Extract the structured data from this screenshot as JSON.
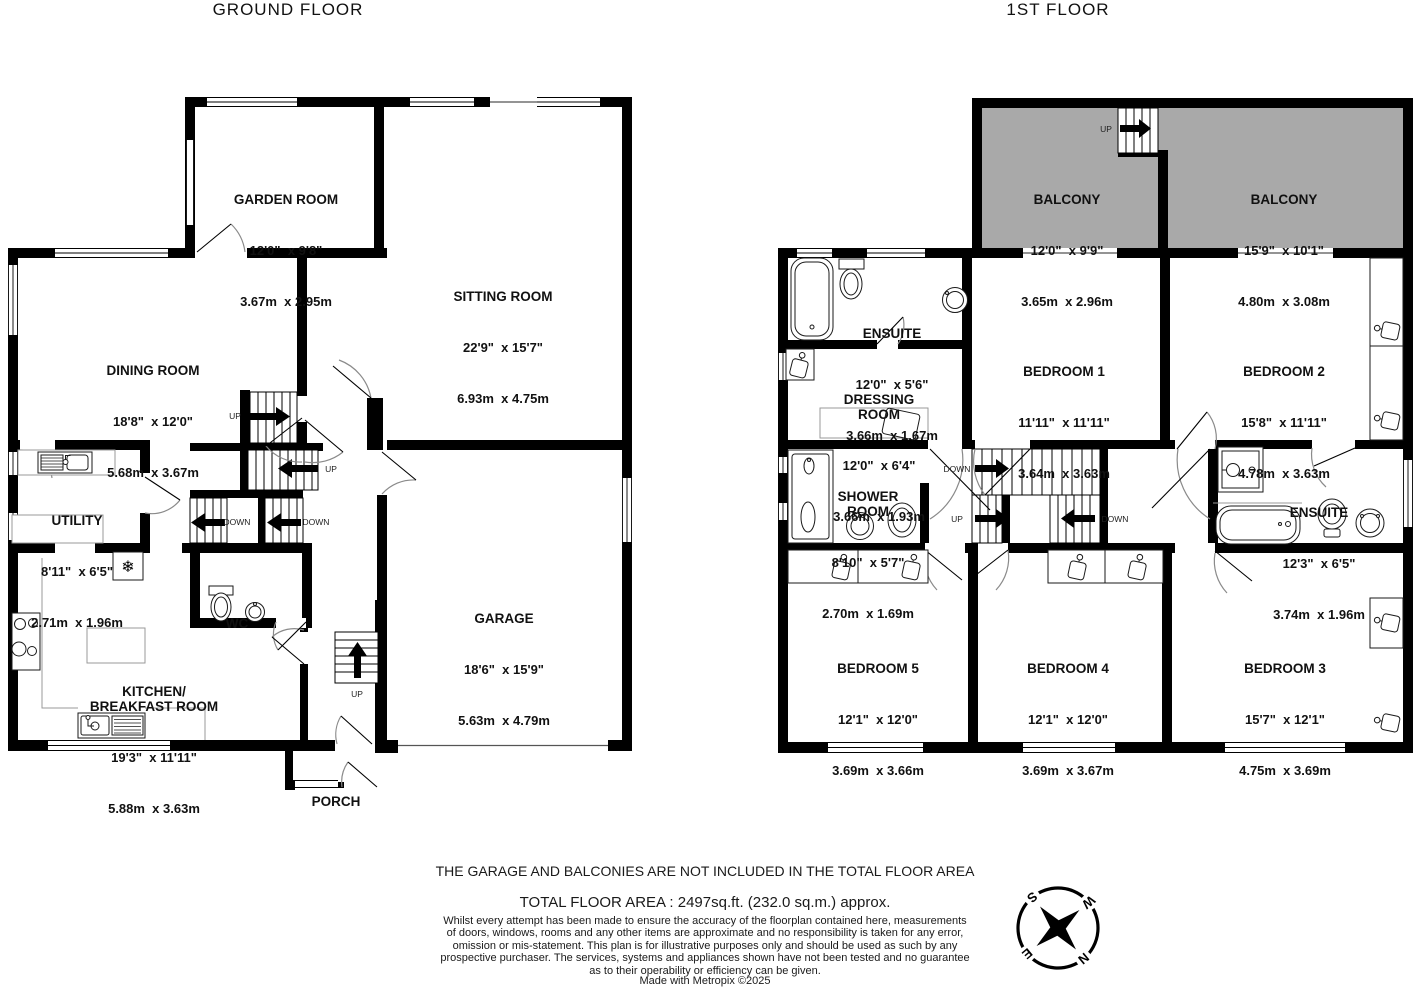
{
  "titles": {
    "ground": "GROUND FLOOR",
    "first": "1ST FLOOR"
  },
  "rooms": {
    "garden": {
      "name": "GARDEN ROOM",
      "imperial": "12'0\"  x 9'8\"",
      "metric": "3.67m  x 2.95m"
    },
    "sitting": {
      "name": "SITTING ROOM",
      "imperial": "22'9\"  x 15'7\"",
      "metric": "6.93m  x 4.75m"
    },
    "dining": {
      "name": "DINING ROOM",
      "imperial": "18'8\"  x 12'0\"",
      "metric": "5.68m  x 3.67m"
    },
    "utility": {
      "name": "UTILITY",
      "imperial": "8'11\"  x 6'5\"",
      "metric": "2.71m  x 1.96m"
    },
    "wc": {
      "name": "WC"
    },
    "kitchen": {
      "name": "KITCHEN/\nBREAKFAST ROOM",
      "imperial": "19'3\"  x 11'11\"",
      "metric": "5.88m  x 3.63m"
    },
    "garage": {
      "name": "GARAGE",
      "imperial": "18'6\"  x 15'9\"",
      "metric": "5.63m  x 4.79m"
    },
    "porch": {
      "name": "PORCH"
    },
    "balcony1": {
      "name": "BALCONY",
      "imperial": "12'0\"  x 9'9\"",
      "metric": "3.65m  x 2.96m"
    },
    "balcony2": {
      "name": "BALCONY",
      "imperial": "15'9\"  x 10'1\"",
      "metric": "4.80m  x 3.08m"
    },
    "ensuite1": {
      "name": "ENSUITE",
      "imperial": "12'0\"  x 5'6\"",
      "metric": "3.66m  x 1.67m"
    },
    "dressing": {
      "name": "DRESSING\nROOM",
      "imperial": "12'0\"  x 6'4\"",
      "metric": "3.66m  x 1.93m"
    },
    "bedroom1": {
      "name": "BEDROOM 1",
      "imperial": "11'11\"  x 11'11\"",
      "metric": "3.64m  x 3.63m"
    },
    "bedroom2": {
      "name": "BEDROOM 2",
      "imperial": "15'8\"  x 11'11\"",
      "metric": "4.78m  x 3.63m"
    },
    "shower": {
      "name": "SHOWER\nROOM",
      "imperial": "8'10\"  x 5'7\"",
      "metric": "2.70m  x 1.69m"
    },
    "ensuite2": {
      "name": "ENSUITE",
      "imperial": "12'3\"  x 6'5\"",
      "metric": "3.74m  x 1.96m"
    },
    "bedroom5": {
      "name": "BEDROOM 5",
      "imperial": "12'1\"  x 12'0\"",
      "metric": "3.69m  x 3.66m"
    },
    "bedroom4": {
      "name": "BEDROOM 4",
      "imperial": "12'1\"  x 12'0\"",
      "metric": "3.69m  x 3.67m"
    },
    "bedroom3": {
      "name": "BEDROOM 3",
      "imperial": "15'7\"  x 12'1\"",
      "metric": "4.75m  x 3.69m"
    }
  },
  "stair_labels": {
    "up": "UP",
    "down": "DOWN"
  },
  "footer": {
    "exclusion_note": "THE GARAGE AND BALCONIES ARE NOT INCLUDED IN THE TOTAL FLOOR AREA",
    "total_area": "TOTAL FLOOR AREA : 2497sq.ft. (232.0 sq.m.) approx.",
    "disclaimer": "Whilst every attempt has been made to ensure the accuracy of the floorplan contained here, measurements\nof doors, windows, rooms and any other items are approximate and no responsibility is taken for any error,\nomission or mis-statement. This plan is for illustrative purposes only and should be used as such by any\nprospective purchaser. The services, systems and appliances shown have not been tested and no guarantee\nas to their operability or efficiency can be given.",
    "credit": "Made with Metropix ©2025"
  },
  "compass": {
    "n": "N",
    "e": "E",
    "s": "S",
    "w": "W"
  },
  "colors": {
    "wall": "#000000",
    "balcony_fill": "#a9a9a9",
    "door_arc": "#8a8a8a",
    "counter_outline": "#999999"
  }
}
